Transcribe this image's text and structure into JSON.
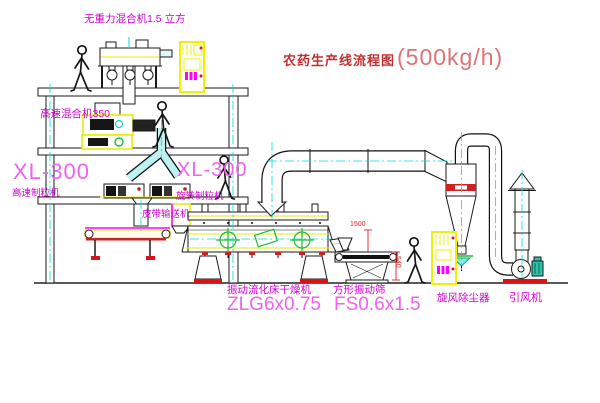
{
  "title": {
    "text": "农药生产线流程图",
    "rate": "(500kg/h)"
  },
  "labels": {
    "gravity_mixer": "无重力混合机1.5 立方",
    "high_speed_mixer": "高速混合机350",
    "xl300_left": "XL-300",
    "xl300_left_sub": "高速制粒机",
    "xl300_center": "XL-300",
    "xl300_center_sub": "旋转制粒机",
    "belt_conveyor": "皮带输送机",
    "dryer_name": "振动流化床干燥机",
    "dryer_model": "ZLG6x0.75",
    "sieve_name": "方形振动筛",
    "sieve_model": "FS0.6x1.5",
    "cyclone": "旋风除尘器",
    "fan": "引风机",
    "dim_height": "1500",
    "dim_width": "540"
  },
  "colors": {
    "equipment_yellow": "#f0f000",
    "pipe_cyan": "#00dcdc",
    "label_magenta": "#cf00cf",
    "label_pink": "#ee62ee",
    "accent_red": "#dd2222",
    "accent_green": "#22bb33",
    "title_red": "#c03232",
    "rate_red": "#dc7474"
  },
  "equipment_shapes": [
    "gravity-mixer",
    "control-cabinet",
    "high-speed-mixer",
    "y-branch-pipe",
    "granulator",
    "discharge-duct",
    "belt-conveyor",
    "feed-hopper",
    "fluid-bed-dryer",
    "exhaust-duct",
    "cyclone-dust-collector",
    "return-duct",
    "exhaust-stack",
    "induced-draft-fan",
    "vibrating-sieve",
    "worker-figure"
  ]
}
